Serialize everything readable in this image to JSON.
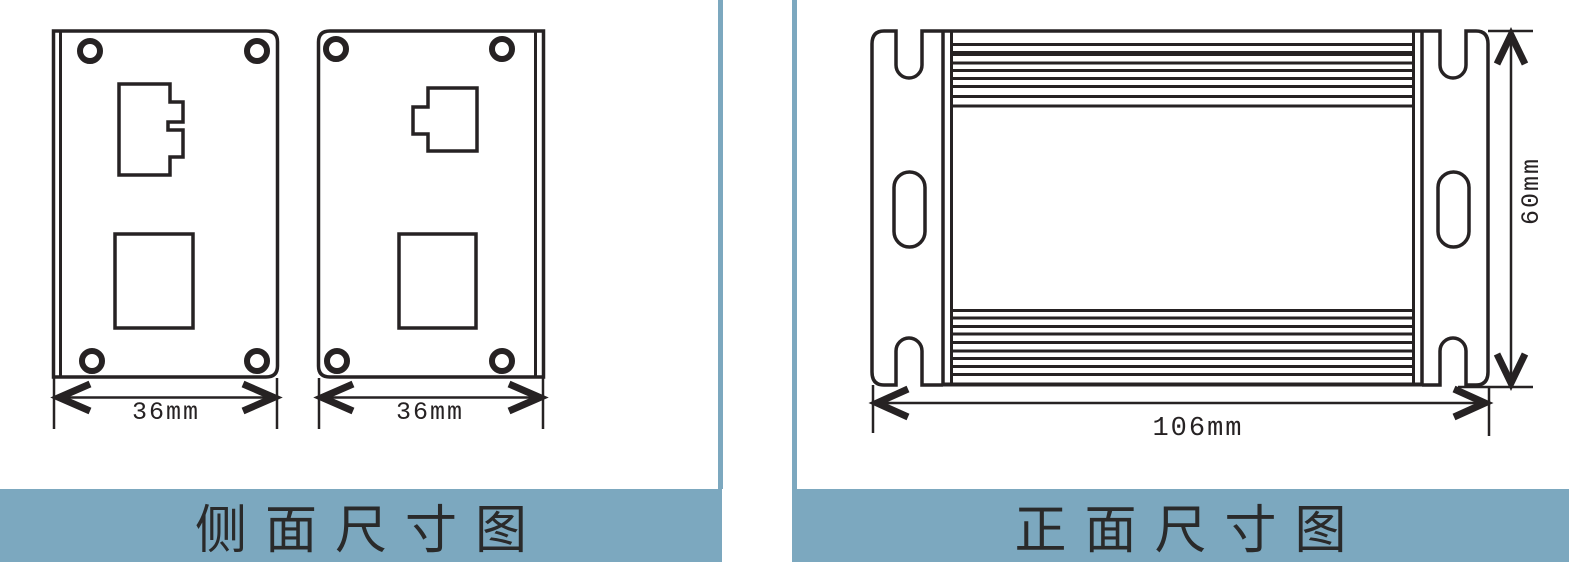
{
  "panels": {
    "left": {
      "caption": "侧面尺寸图",
      "views": [
        {
          "name": "side-view-a",
          "width_label": "36mm"
        },
        {
          "name": "side-view-b",
          "width_label": "36mm"
        }
      ]
    },
    "right": {
      "caption": "正面尺寸图",
      "view": {
        "name": "front-view",
        "width_label": "106mm",
        "height_label": "60mm"
      }
    }
  },
  "colors": {
    "accent_blue": "#7ca8bf",
    "line": "#262223",
    "caption_text": "#2a2a2a"
  }
}
